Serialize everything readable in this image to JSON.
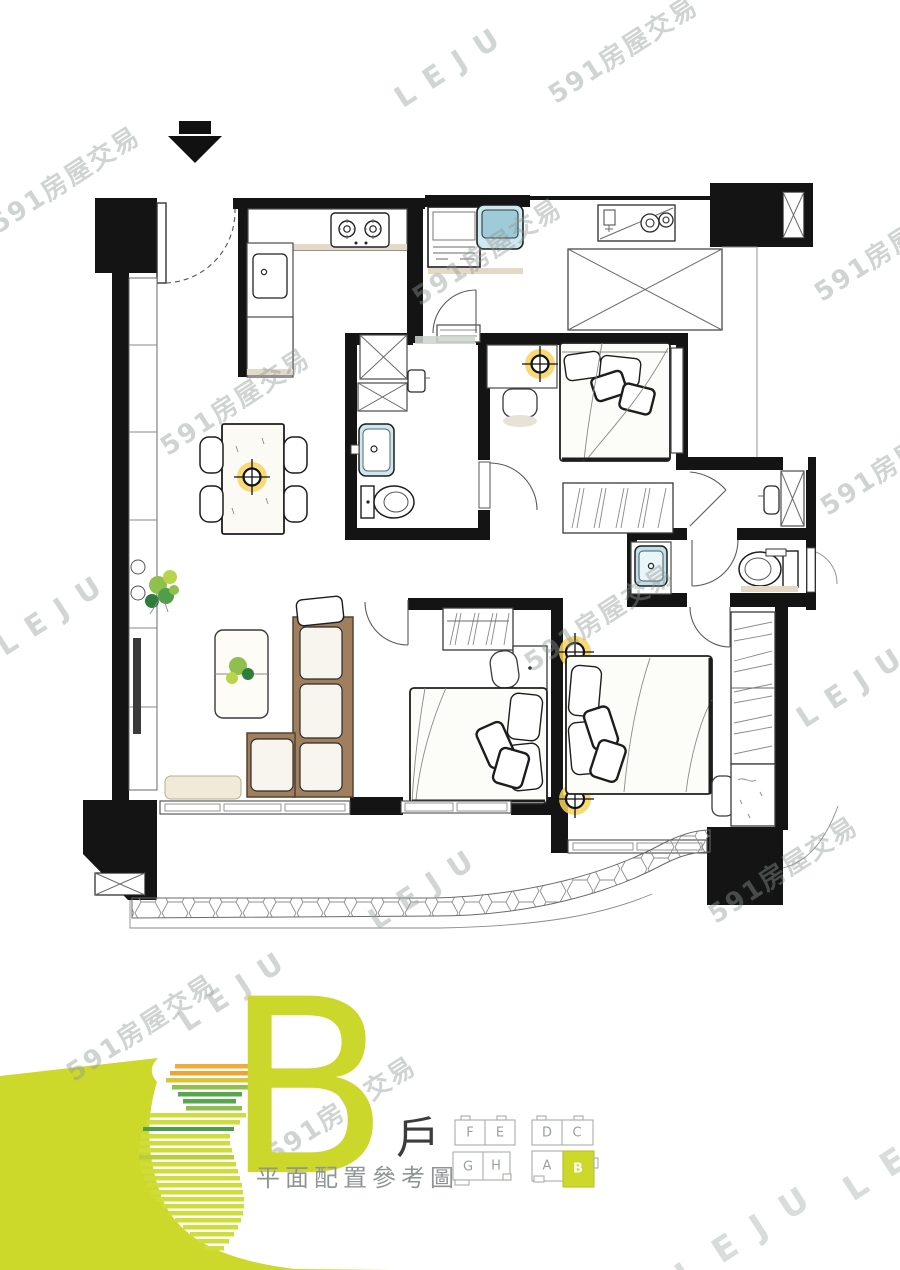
{
  "watermarks": {
    "brand": "591房屋交易",
    "leju": "LEJU"
  },
  "footer": {
    "unit_letter": "B",
    "unit_label": "戶",
    "caption": "平面配置參考圖",
    "accent_color": "#ccd82a",
    "keyplan": {
      "highlight": "B",
      "units": [
        {
          "label": "F"
        },
        {
          "label": "E"
        },
        {
          "label": "D"
        },
        {
          "label": "C"
        },
        {
          "label": "G"
        },
        {
          "label": "H"
        },
        {
          "label": "A"
        },
        {
          "label": "B"
        }
      ]
    }
  }
}
